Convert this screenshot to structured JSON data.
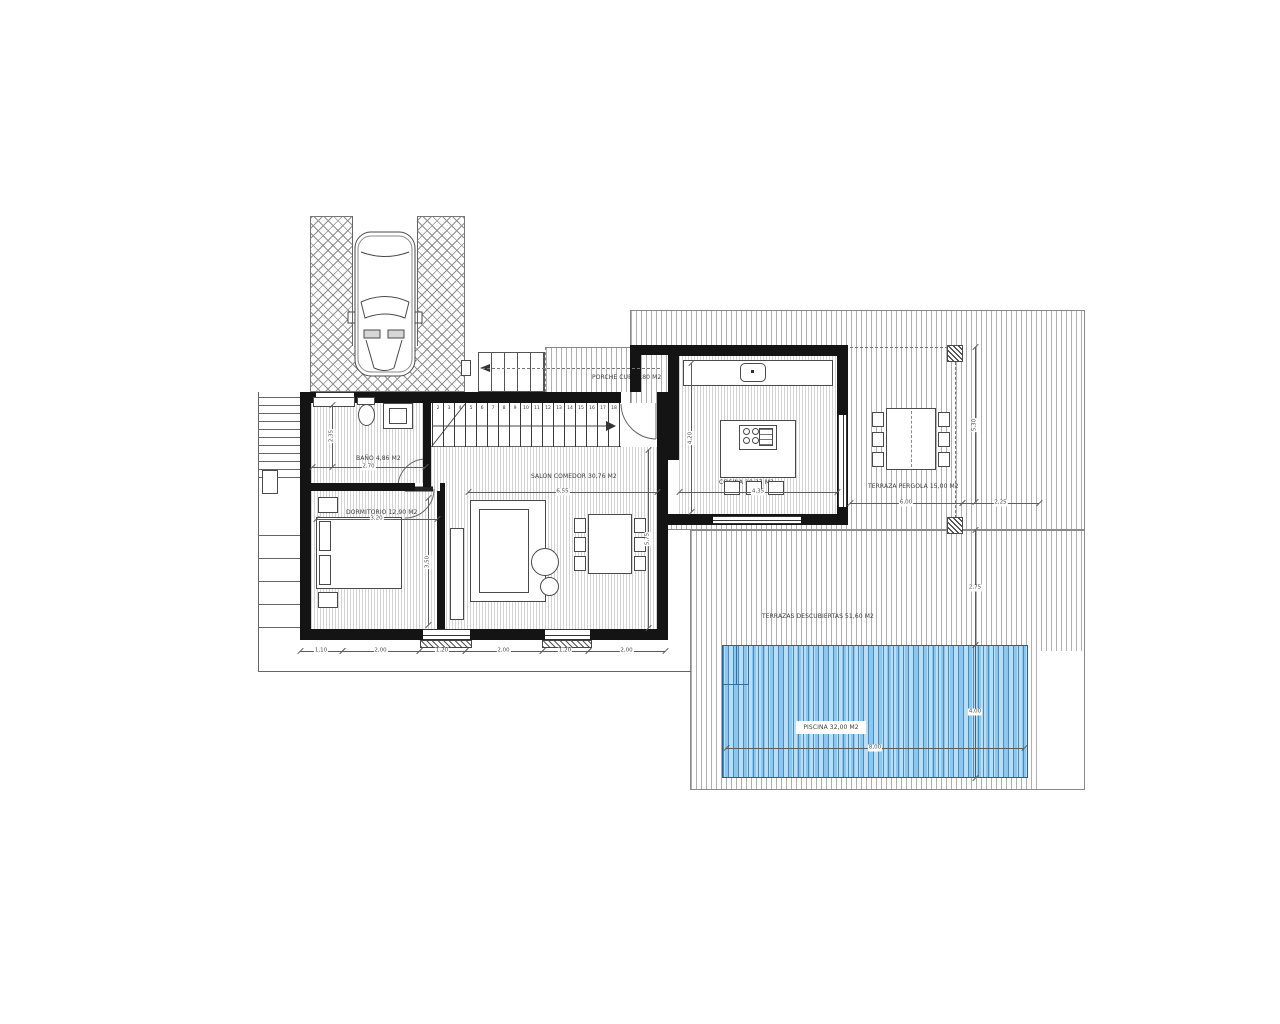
{
  "title": "Villa floor plan",
  "rooms": {
    "porche": {
      "label": "PORCHE CUB. 1,80 M2"
    },
    "bano": {
      "label": "BAÑO 4,86 M2"
    },
    "dormitorio": {
      "label": "DORMITORIO 12,90 M2"
    },
    "salon": {
      "label": "SALON COMEDOR 30,76 M2"
    },
    "cocina": {
      "label": "COCINA 18,27 M2"
    },
    "terraza_pergola": {
      "label": "TERRAZA PERGOLA 15,00 M2"
    },
    "terrazas_descubiertas": {
      "label": "TERRAZAS DESCUBIERTAS 51,60 M2"
    },
    "piscina": {
      "label": "PISCINA 32,00 M2"
    }
  },
  "colors": {
    "wall": "#141414",
    "pool_dark": "#3f8ec9",
    "pool_mid": "#8ec6ec",
    "pool_light": "#bcdcf2",
    "hatch_line": "#8a8a8a",
    "dim_line": "#5c5c5c"
  },
  "stairs": {
    "treads": [
      "2",
      "3",
      "4",
      "5",
      "6",
      "7",
      "8",
      "9",
      "10",
      "11",
      "12",
      "13",
      "14",
      "15",
      "16",
      "17",
      "18"
    ],
    "x0": 432,
    "y0": 403,
    "height": 44,
    "cell": 11
  },
  "drawing": {
    "walls": [
      [
        300,
        392,
        321,
        11
      ],
      [
        657,
        392,
        11,
        248
      ],
      [
        300,
        392,
        11,
        248
      ],
      [
        300,
        629,
        368,
        11
      ],
      [
        300,
        483,
        115,
        8
      ],
      [
        440,
        483,
        5,
        8
      ],
      [
        423,
        398,
        8,
        89
      ],
      [
        437,
        491,
        8,
        149
      ],
      [
        668,
        345,
        180,
        11
      ],
      [
        837,
        356,
        11,
        169
      ],
      [
        668,
        514,
        180,
        11
      ],
      [
        668,
        356,
        11,
        104
      ],
      [
        630,
        345,
        40,
        10
      ],
      [
        630,
        355,
        11,
        37
      ]
    ],
    "windows": [
      [
        316,
        392,
        38,
        11,
        "h"
      ],
      [
        423,
        629,
        47,
        11,
        "h"
      ],
      [
        545,
        629,
        45,
        11,
        "h"
      ],
      [
        838,
        415,
        9,
        92,
        "v"
      ],
      [
        713,
        516,
        88,
        8,
        "h"
      ]
    ],
    "sills": [
      [
        420,
        640,
        52,
        8
      ],
      [
        542,
        640,
        50,
        8
      ]
    ],
    "lines": [
      [
        258,
        392,
        1,
        280,
        ""
      ],
      [
        258,
        671,
        433,
        1,
        ""
      ],
      [
        352,
        216,
        1,
        130,
        ""
      ],
      [
        417,
        216,
        1,
        130,
        ""
      ],
      [
        431,
        446,
        190,
        1,
        ""
      ],
      [
        736,
        646,
        1,
        38,
        "blue"
      ],
      [
        748,
        646,
        1,
        38,
        "blue"
      ],
      [
        723,
        684,
        26,
        1,
        "blue"
      ],
      [
        482,
        368,
        178,
        1,
        "dash-h"
      ],
      [
        850,
        347,
        98,
        1,
        "dash-h"
      ],
      [
        955,
        362,
        1,
        156,
        "dash-v"
      ]
    ],
    "left_steps": {
      "x": 258,
      "w": 42,
      "ys": [
        397,
        405,
        413,
        421,
        429,
        437,
        445,
        453,
        461,
        469,
        477,
        535,
        558,
        581,
        604,
        627
      ]
    },
    "boxes": [
      {
        "x": 588,
        "y": 514,
        "w": 44,
        "h": 60,
        "n": "dining-table"
      },
      {
        "x": 574,
        "y": 518,
        "w": 12,
        "h": 15,
        "n": "chair"
      },
      {
        "x": 574,
        "y": 537,
        "w": 12,
        "h": 15,
        "n": "chair"
      },
      {
        "x": 574,
        "y": 556,
        "w": 12,
        "h": 15,
        "n": "chair"
      },
      {
        "x": 634,
        "y": 518,
        "w": 12,
        "h": 15,
        "n": "chair"
      },
      {
        "x": 634,
        "y": 537,
        "w": 12,
        "h": 15,
        "n": "chair"
      },
      {
        "x": 634,
        "y": 556,
        "w": 12,
        "h": 15,
        "n": "chair"
      },
      {
        "x": 886,
        "y": 408,
        "w": 50,
        "h": 62,
        "c": "dashc",
        "n": "pergola-table"
      },
      {
        "x": 872,
        "y": 412,
        "w": 12,
        "h": 15,
        "n": "chair"
      },
      {
        "x": 872,
        "y": 432,
        "w": 12,
        "h": 15,
        "n": "chair"
      },
      {
        "x": 872,
        "y": 452,
        "w": 12,
        "h": 15,
        "n": "chair"
      },
      {
        "x": 938,
        "y": 412,
        "w": 12,
        "h": 15,
        "n": "chair"
      },
      {
        "x": 938,
        "y": 432,
        "w": 12,
        "h": 15,
        "n": "chair"
      },
      {
        "x": 938,
        "y": 452,
        "w": 12,
        "h": 15,
        "n": "chair"
      },
      {
        "x": 316,
        "y": 517,
        "w": 86,
        "h": 72,
        "n": "bed"
      },
      {
        "x": 319,
        "y": 521,
        "w": 12,
        "h": 30,
        "n": "pillow"
      },
      {
        "x": 319,
        "y": 555,
        "w": 12,
        "h": 30,
        "n": "pillow"
      },
      {
        "x": 318,
        "y": 497,
        "w": 20,
        "h": 16,
        "n": "nightstand"
      },
      {
        "x": 318,
        "y": 592,
        "w": 20,
        "h": 16,
        "n": "nightstand"
      },
      {
        "x": 450,
        "y": 528,
        "w": 14,
        "h": 92,
        "n": "tv-unit"
      },
      {
        "x": 470,
        "y": 500,
        "w": 76,
        "h": 102,
        "n": "sofa"
      },
      {
        "x": 479,
        "y": 509,
        "w": 50,
        "h": 84,
        "n": "sofa-seat"
      },
      {
        "x": 531,
        "y": 548,
        "w": 28,
        "h": 28,
        "c": "r",
        "n": "side-table"
      },
      {
        "x": 540,
        "y": 577,
        "w": 19,
        "h": 19,
        "c": "r",
        "n": "side-table"
      },
      {
        "x": 313,
        "y": 397,
        "w": 42,
        "h": 10,
        "n": "bath-shelf"
      },
      {
        "x": 357,
        "y": 397,
        "w": 18,
        "h": 8,
        "n": "wc-tank"
      },
      {
        "x": 358,
        "y": 404,
        "w": 17,
        "h": 22,
        "c": "r",
        "n": "wc-bowl"
      },
      {
        "x": 383,
        "y": 403,
        "w": 30,
        "h": 26,
        "n": "vanity"
      },
      {
        "x": 389,
        "y": 408,
        "w": 18,
        "h": 16,
        "n": "vanity-basin"
      },
      {
        "x": 683,
        "y": 360,
        "w": 150,
        "h": 26,
        "n": "kitchen-counter"
      },
      {
        "x": 740,
        "y": 363,
        "w": 26,
        "h": 19,
        "c": "rr",
        "n": "kitchen-sink"
      },
      {
        "x": 751,
        "y": 370,
        "w": 3,
        "h": 3,
        "c": "fillb",
        "n": "faucet"
      },
      {
        "x": 720,
        "y": 420,
        "w": 76,
        "h": 58,
        "n": "kitchen-island"
      },
      {
        "x": 739,
        "y": 425,
        "w": 38,
        "h": 25,
        "n": "hob"
      },
      {
        "x": 743,
        "y": 428,
        "w": 7,
        "h": 7,
        "c": "r",
        "n": "burner"
      },
      {
        "x": 752,
        "y": 428,
        "w": 7,
        "h": 7,
        "c": "r",
        "n": "burner"
      },
      {
        "x": 743,
        "y": 437,
        "w": 7,
        "h": 7,
        "c": "r",
        "n": "burner"
      },
      {
        "x": 752,
        "y": 437,
        "w": 7,
        "h": 7,
        "c": "r",
        "n": "burner"
      },
      {
        "x": 759,
        "y": 428,
        "w": 14,
        "h": 18,
        "c": "hl",
        "n": "grill"
      },
      {
        "x": 724,
        "y": 481,
        "w": 16,
        "h": 14,
        "n": "stool"
      },
      {
        "x": 746,
        "y": 481,
        "w": 16,
        "h": 14,
        "n": "stool"
      },
      {
        "x": 768,
        "y": 481,
        "w": 16,
        "h": 14,
        "n": "stool"
      },
      {
        "x": 947,
        "y": 345,
        "w": 16,
        "h": 17,
        "c": "col",
        "n": "pergola-column"
      },
      {
        "x": 947,
        "y": 517,
        "w": 16,
        "h": 17,
        "c": "col",
        "n": "pergola-column"
      },
      {
        "x": 262,
        "y": 470,
        "w": 16,
        "h": 24,
        "n": "pillar"
      },
      {
        "x": 461,
        "y": 360,
        "w": 10,
        "h": 16,
        "n": "pillar"
      }
    ],
    "dims": [
      {
        "o": "h",
        "x": 312,
        "y": 467,
        "len": 113,
        "label": "2,70",
        "rot": 0
      },
      {
        "o": "h",
        "x": 316,
        "y": 519,
        "len": 121,
        "label": "3,20",
        "rot": 0
      },
      {
        "o": "h",
        "x": 468,
        "y": 492,
        "len": 189,
        "label": "6,55",
        "rot": 0
      },
      {
        "o": "h",
        "x": 679,
        "y": 492,
        "len": 158,
        "label": "4,35",
        "rot": 0
      },
      {
        "o": "h",
        "x": 850,
        "y": 503,
        "len": 112,
        "label": "6,00",
        "rot": 0
      },
      {
        "o": "h",
        "x": 962,
        "y": 503,
        "len": 77,
        "label": "2,25",
        "rot": 0
      },
      {
        "o": "h",
        "x": 726,
        "y": 748,
        "len": 298,
        "label": "8,00",
        "rot": 0
      },
      {
        "o": "h",
        "x": 300,
        "y": 651,
        "len": 42,
        "label": "1,10",
        "rot": 0
      },
      {
        "o": "h",
        "x": 342,
        "y": 651,
        "len": 77,
        "label": "2,00",
        "rot": 0
      },
      {
        "o": "h",
        "x": 419,
        "y": 651,
        "len": 46,
        "label": "1,20",
        "rot": 0
      },
      {
        "o": "h",
        "x": 465,
        "y": 651,
        "len": 77,
        "label": "2,00",
        "rot": 0
      },
      {
        "o": "h",
        "x": 542,
        "y": 651,
        "len": 46,
        "label": "1,20",
        "rot": 0
      },
      {
        "o": "h",
        "x": 588,
        "y": 651,
        "len": 77,
        "label": "2,00",
        "rot": 0
      },
      {
        "o": "v",
        "x": 332,
        "y": 405,
        "len": 62,
        "label": "2,35",
        "rot": 1
      },
      {
        "o": "v",
        "x": 428,
        "y": 498,
        "len": 127,
        "label": "3,50",
        "rot": 1
      },
      {
        "o": "v",
        "x": 648,
        "y": 450,
        "len": 178,
        "label": "5,75",
        "rot": 1
      },
      {
        "o": "v",
        "x": 691,
        "y": 363,
        "len": 149,
        "label": "4,20",
        "rot": 1
      },
      {
        "o": "v",
        "x": 975,
        "y": 347,
        "len": 155,
        "label": "5,30",
        "rot": 1
      },
      {
        "o": "v",
        "x": 975,
        "y": 530,
        "len": 115,
        "label": "2,75",
        "rot": 0
      },
      {
        "o": "v",
        "x": 975,
        "y": 645,
        "len": 133,
        "label": "4,00",
        "rot": 0
      }
    ]
  }
}
